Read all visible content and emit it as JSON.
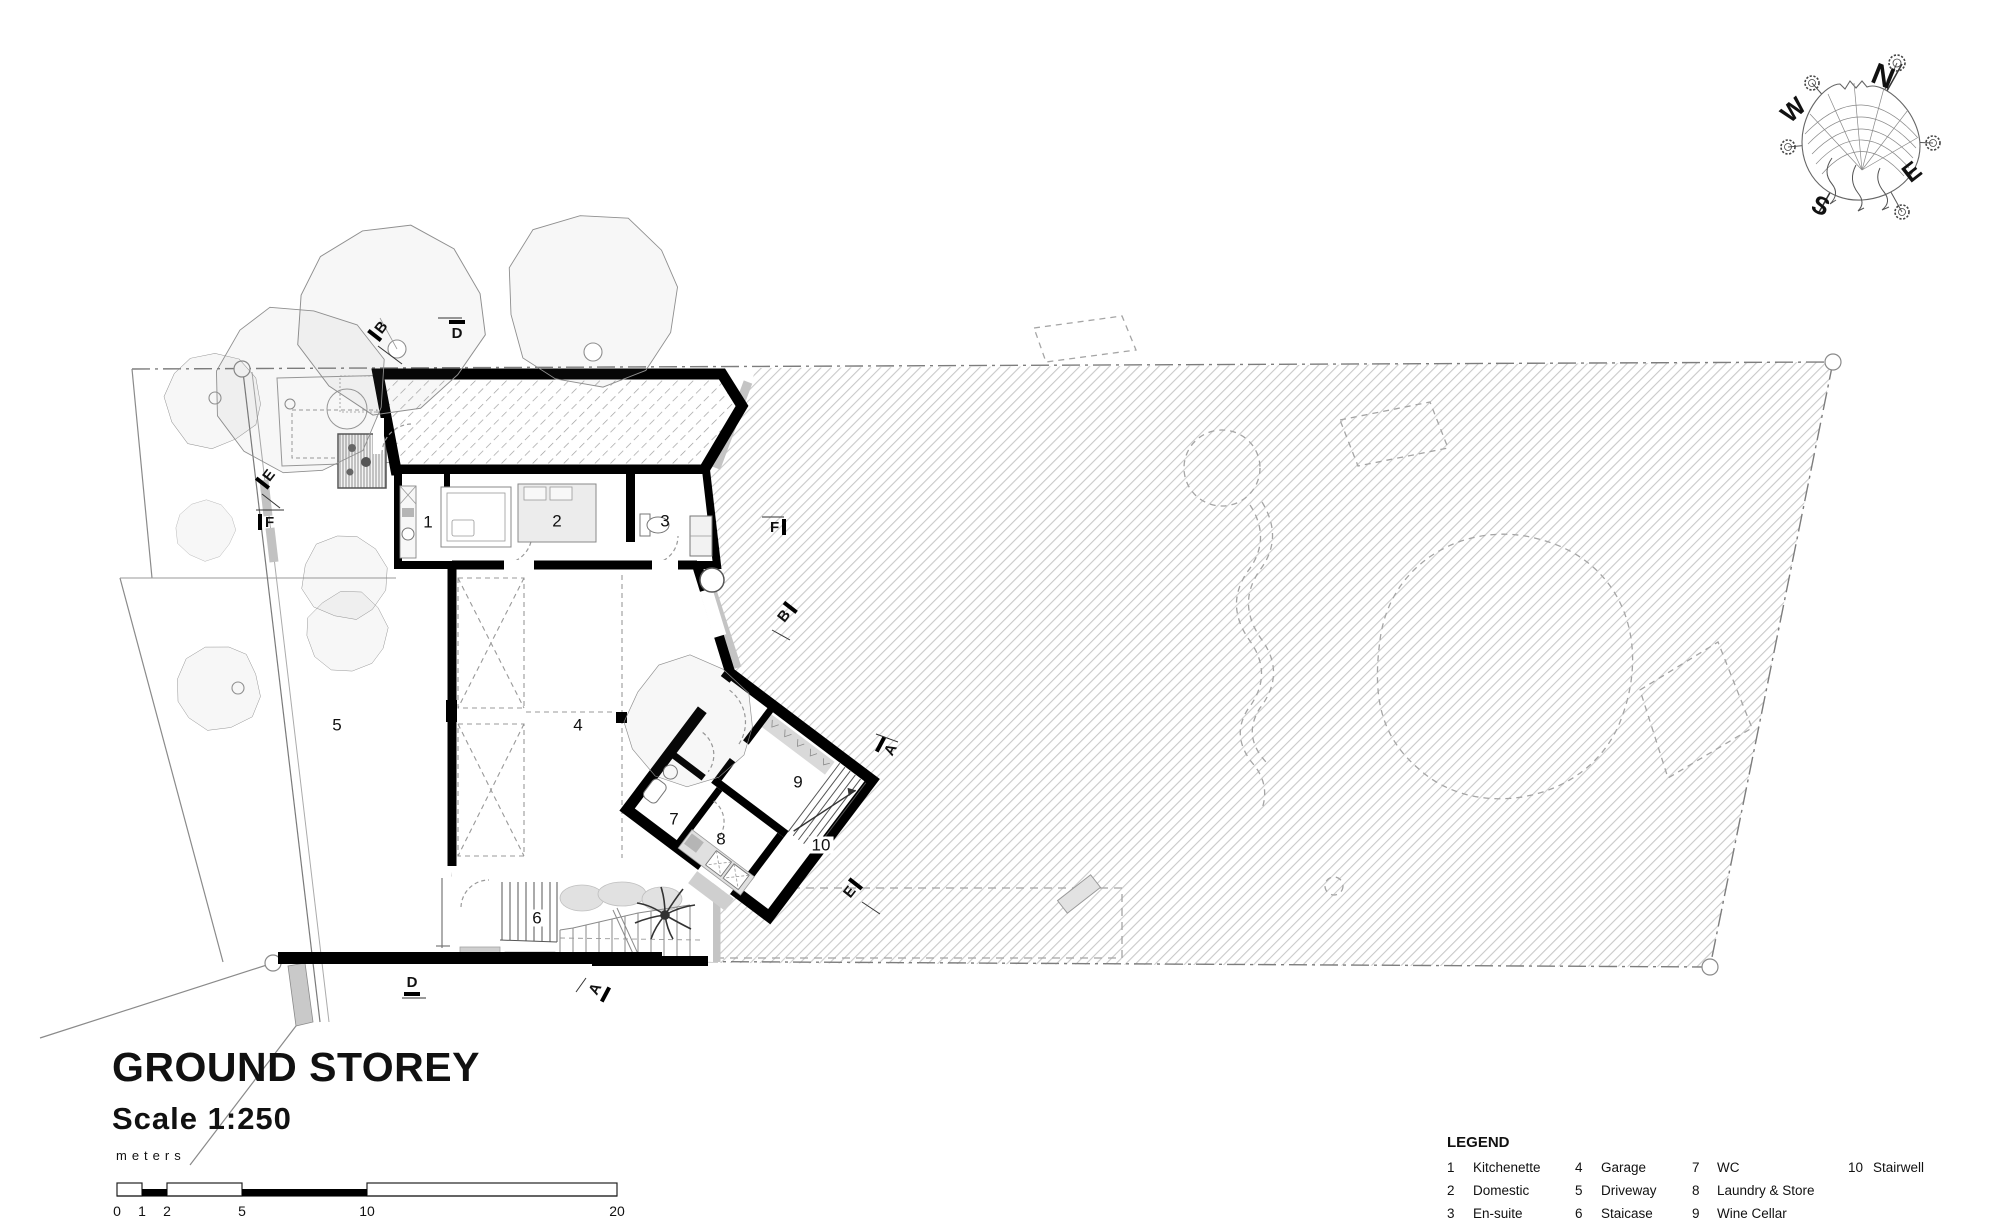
{
  "title": {
    "heading": "GROUND STOREY",
    "scale": "Scale 1:250"
  },
  "scale_bar": {
    "units": "meters",
    "ticks": [
      "0",
      "1",
      "2",
      "5",
      "10",
      "20"
    ]
  },
  "compass": {
    "points": [
      {
        "letter": "N"
      },
      {
        "letter": "W"
      },
      {
        "letter": "E"
      },
      {
        "letter": "S"
      }
    ]
  },
  "plan": {
    "rooms": [
      {
        "num": "1"
      },
      {
        "num": "2"
      },
      {
        "num": "3"
      },
      {
        "num": "4"
      },
      {
        "num": "5"
      },
      {
        "num": "6"
      },
      {
        "num": "7"
      },
      {
        "num": "8"
      },
      {
        "num": "9"
      },
      {
        "num": "10"
      }
    ],
    "markers": [
      {
        "letter": "B"
      },
      {
        "letter": "D"
      },
      {
        "letter": "E"
      },
      {
        "letter": "F"
      },
      {
        "letter": "F"
      },
      {
        "letter": "B"
      },
      {
        "letter": "A"
      },
      {
        "letter": "E"
      },
      {
        "letter": "D"
      },
      {
        "letter": "A"
      }
    ]
  },
  "legend": {
    "heading": "LEGEND",
    "items": [
      {
        "num": "1",
        "label": "Kitchenette"
      },
      {
        "num": "2",
        "label": "Domestic"
      },
      {
        "num": "3",
        "label": "En-suite"
      },
      {
        "num": "4",
        "label": "Garage"
      },
      {
        "num": "5",
        "label": "Driveway"
      },
      {
        "num": "6",
        "label": "Staicase"
      },
      {
        "num": "7",
        "label": "WC"
      },
      {
        "num": "8",
        "label": "Laundry & Store"
      },
      {
        "num": "9",
        "label": "Wine Cellar"
      },
      {
        "num": "10",
        "label": "Stairwell"
      }
    ]
  }
}
